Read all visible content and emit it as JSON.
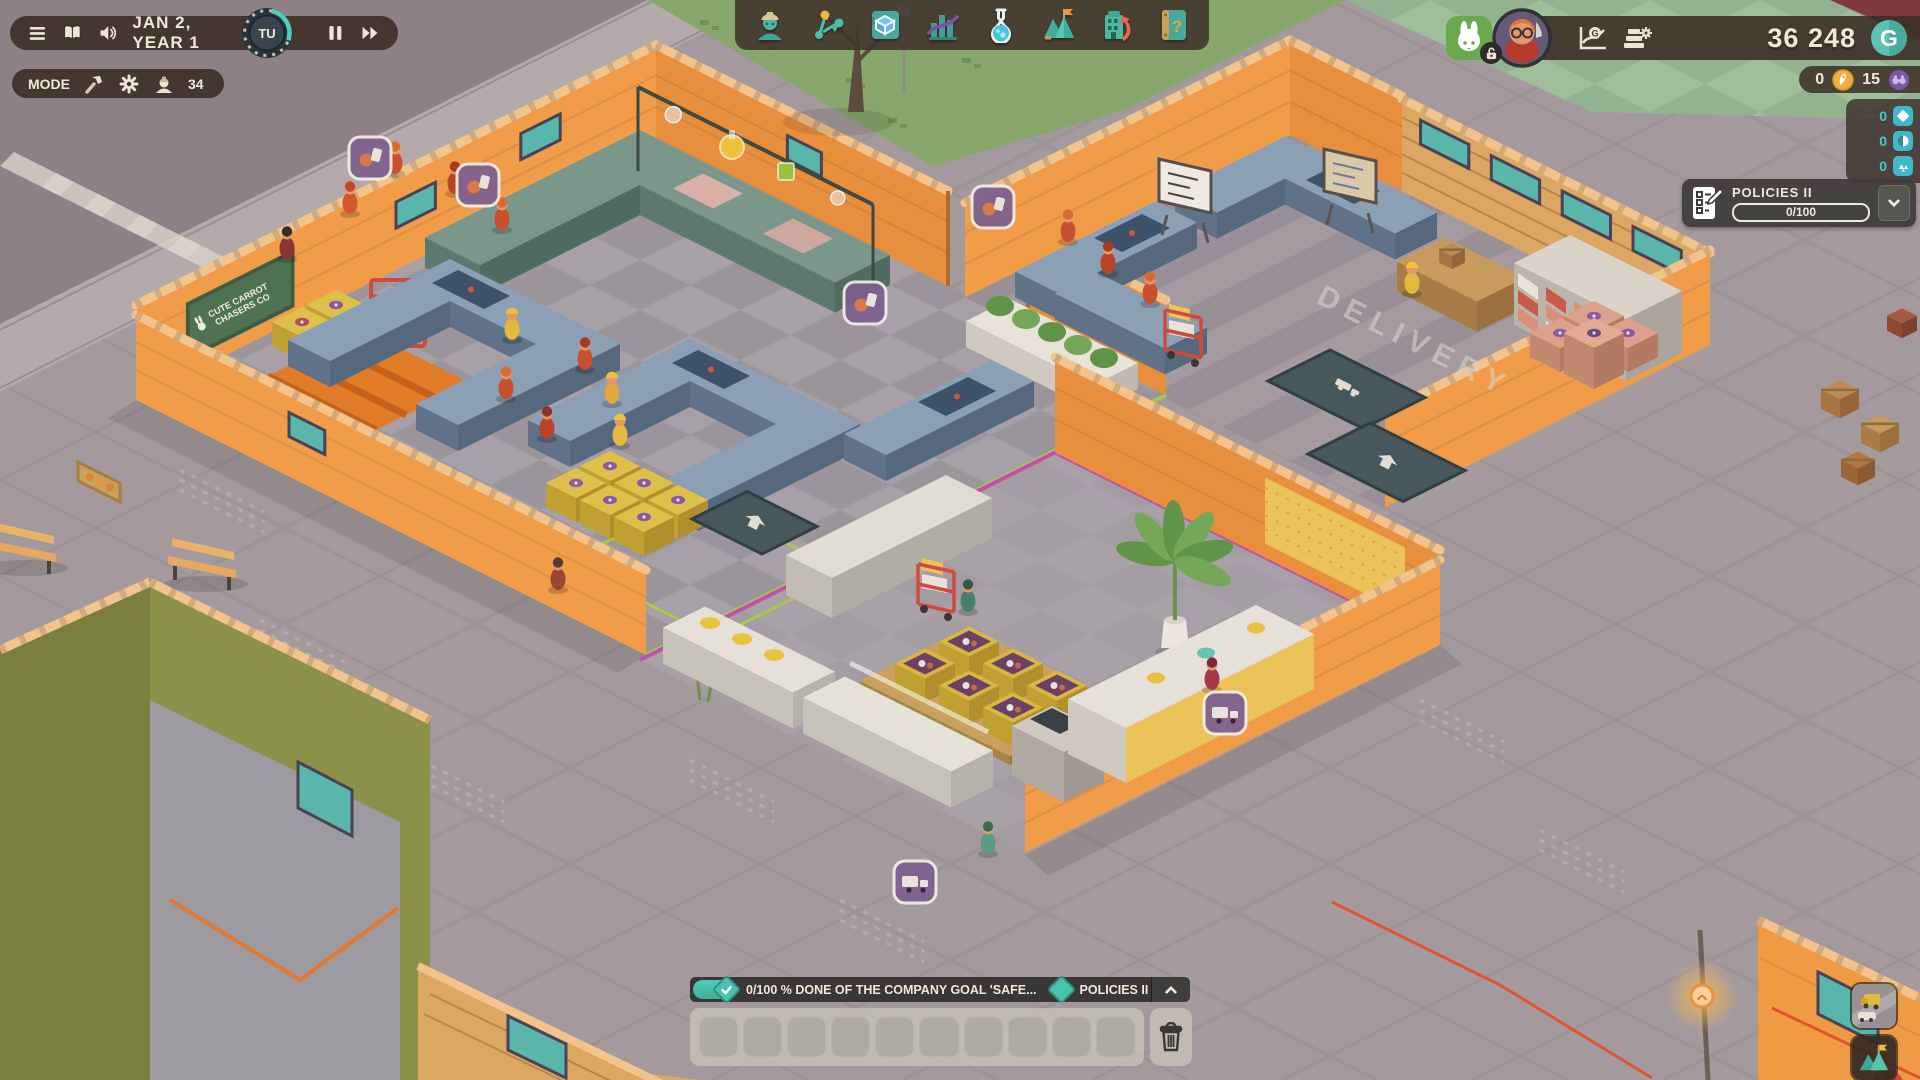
{
  "hud": {
    "time_bar": {
      "date": "JAN 2, YEAR 1",
      "speed_label": "TU"
    },
    "mode_bar": {
      "label": "MODE",
      "worker_count": "34"
    },
    "toolbar": {
      "items": [
        "employees",
        "logistics",
        "blueprints",
        "statistics",
        "research",
        "milestones",
        "company",
        "handbook"
      ]
    },
    "wallet": {
      "balance": "36 248",
      "currency_symbol": "G"
    },
    "boosters": {
      "rocket_tokens": "0",
      "scout_tokens": "15"
    },
    "research_points": [
      {
        "icon": "diamond-point",
        "value": "0"
      },
      {
        "icon": "orb-point",
        "value": "0"
      },
      {
        "icon": "shard-point",
        "value": "0"
      }
    ],
    "policies_panel": {
      "title": "POLICIES II",
      "progress": "0/100"
    },
    "goal_bar": {
      "progress_text": "0/100 % DONE OF THE COMPANY GOAL 'SAFE...",
      "milestone_label": "POLICIES II"
    },
    "hotbar": {
      "slot_count": 10
    },
    "colors": {
      "accent_teal": "#49c3ae",
      "money_teal": "#59c4b4",
      "research_cyan": "#47c8d6",
      "mascot_green": "#69a84e"
    }
  },
  "scene": {
    "company_sign_line1": "CUTE CARROT",
    "company_sign_line2": "CHASERS CO",
    "delivery_floor_label": "DELIVERY"
  }
}
